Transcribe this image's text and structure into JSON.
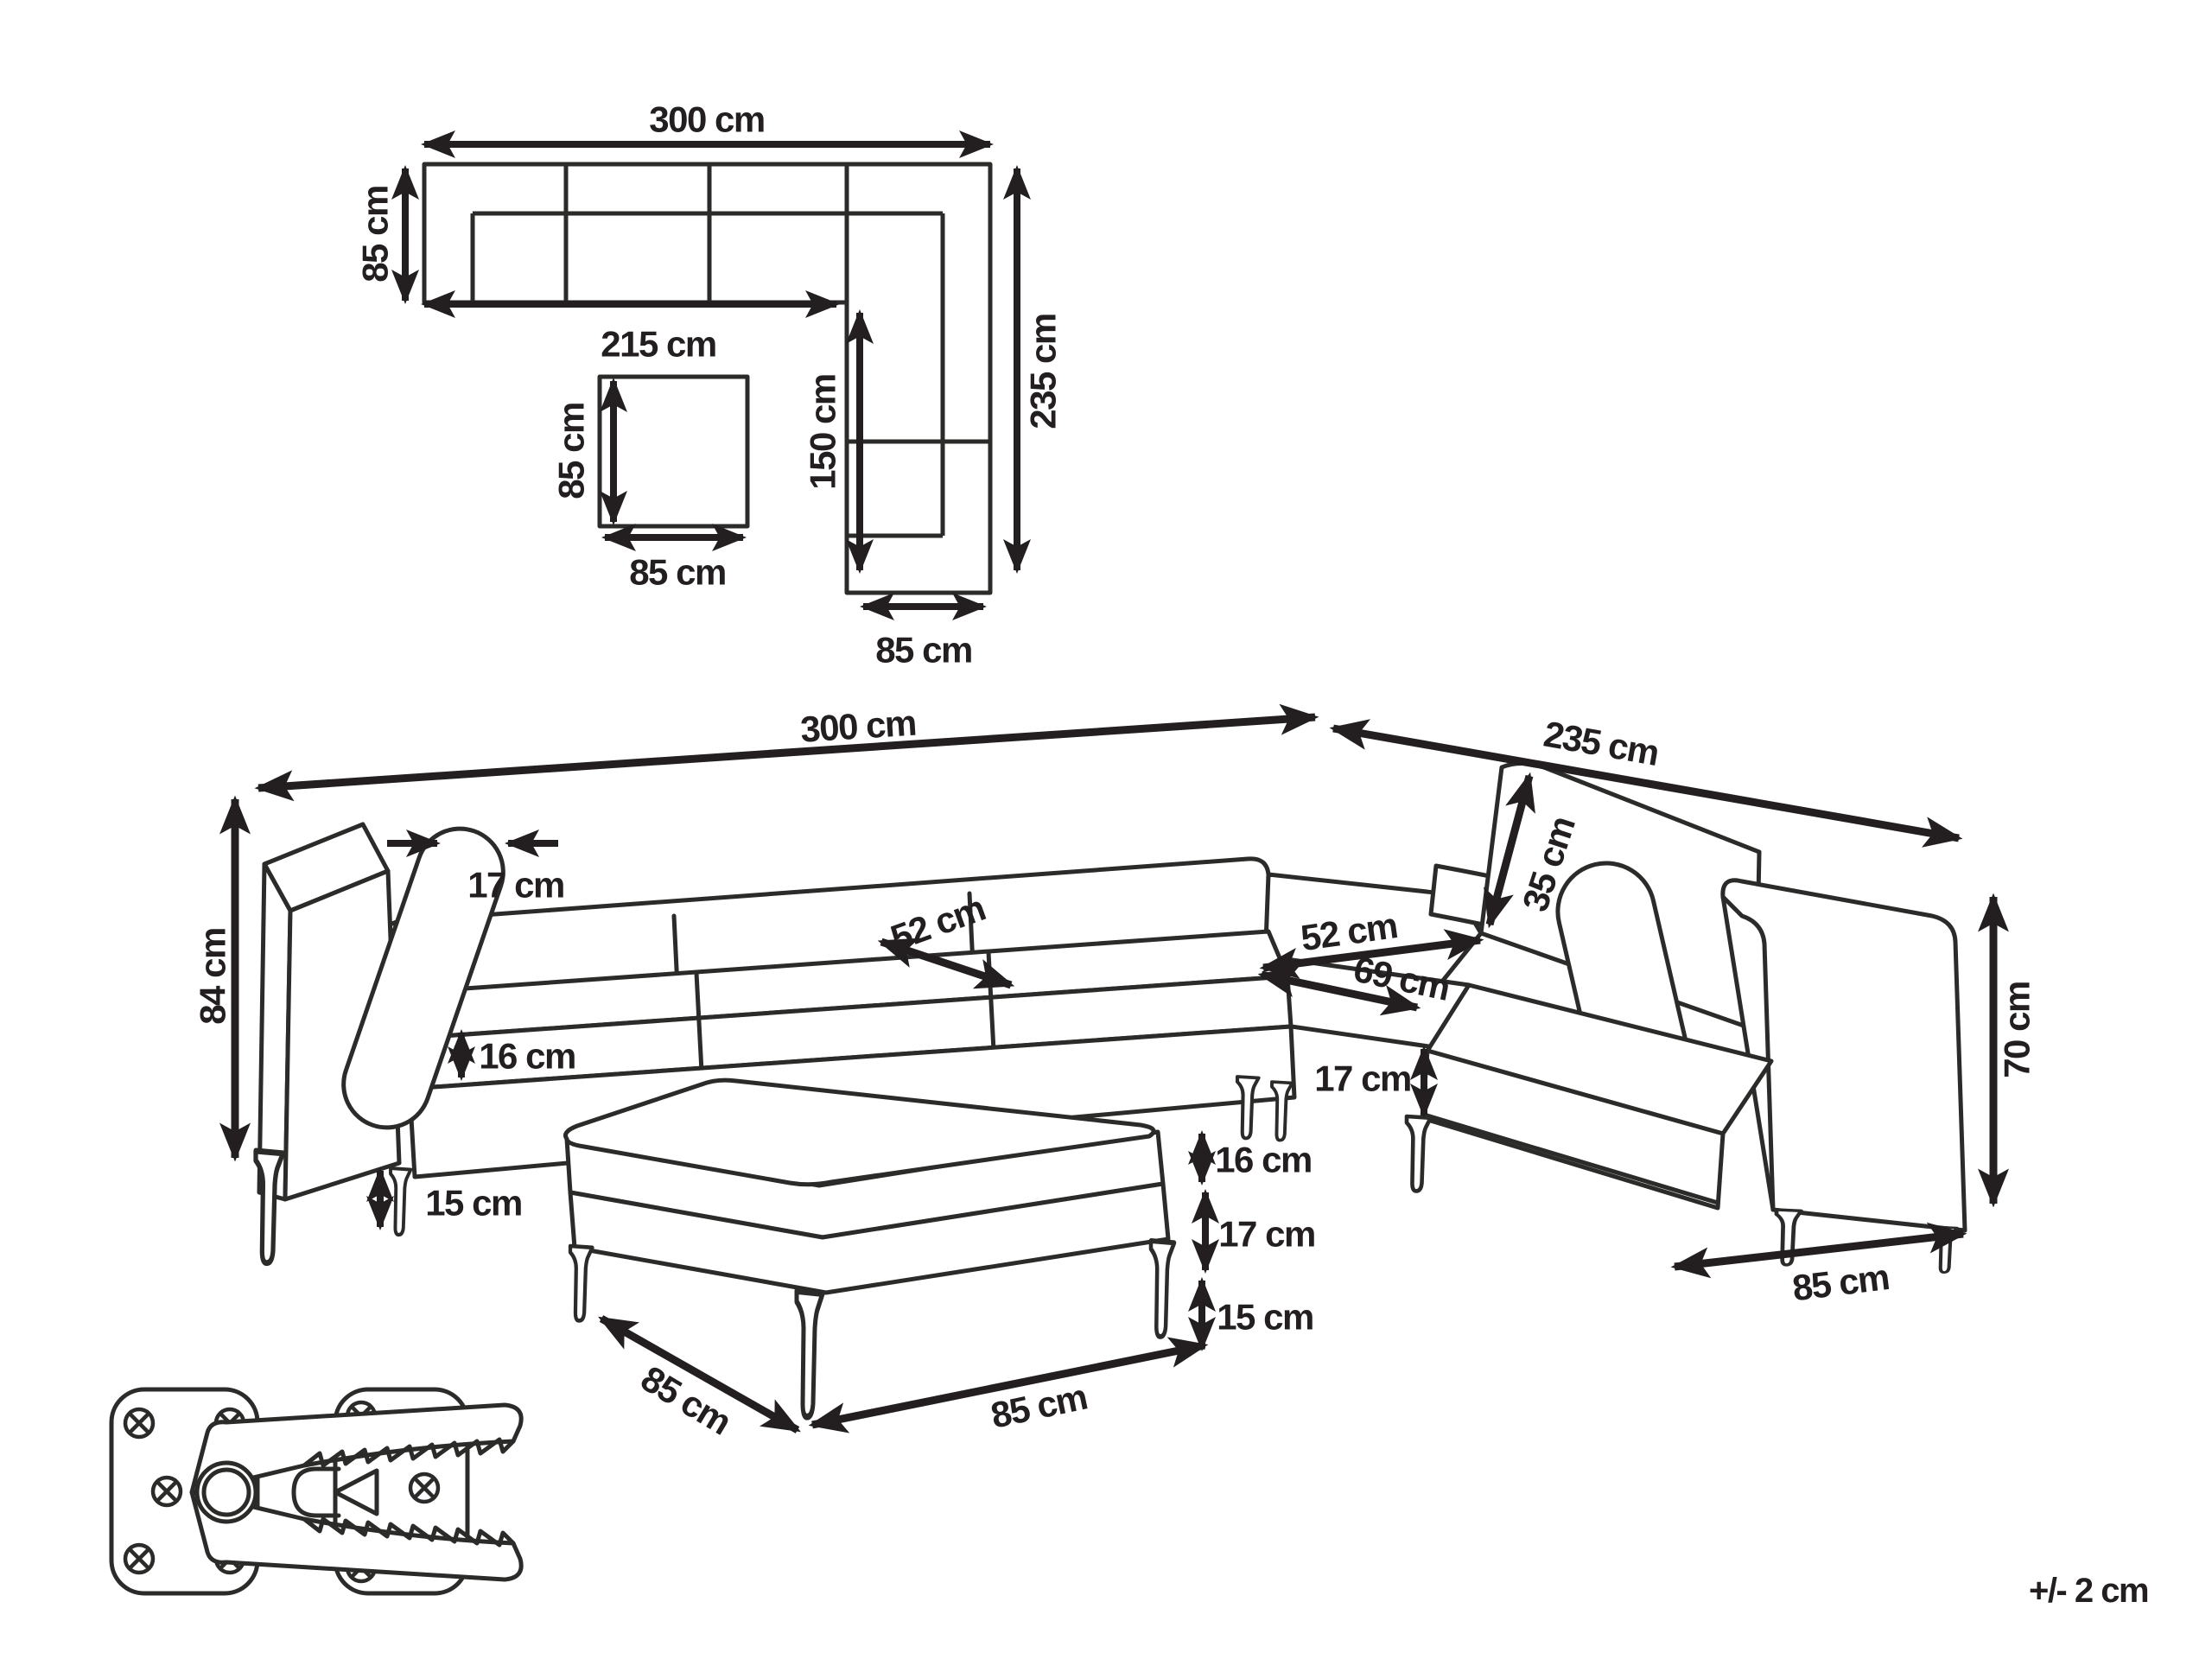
{
  "plan_view": {
    "width_top": "300 cm",
    "depth_left": "85 cm",
    "inner_width": "215 cm",
    "inner_length": "150 cm",
    "length_right": "235 cm",
    "width_bottom": "85 cm",
    "ottoman": {
      "depth": "85 cm",
      "width": "85 cm"
    }
  },
  "perspective_view": {
    "width_total": "300 cm",
    "depth_total": "235 cm",
    "height_total": "84 cm",
    "back_cushion_thickness": "17 cm",
    "back_cushion_height": "35 cm",
    "seat_depth_left": "52 cm",
    "seat_depth_right": "52 cm",
    "corner_seat_width": "69 cm",
    "seat_base_height": "16 cm",
    "corner_base_height": "17 cm",
    "leg_height": "15 cm",
    "armrest_height": "70 cm",
    "side_width": "85 cm",
    "ottoman": {
      "cushion_height": "16 cm",
      "base_height": "17 cm",
      "leg_height": "15 cm",
      "side_depth": "85 cm",
      "front_width": "85 cm"
    }
  },
  "tolerance_note": "+/- 2 cm"
}
